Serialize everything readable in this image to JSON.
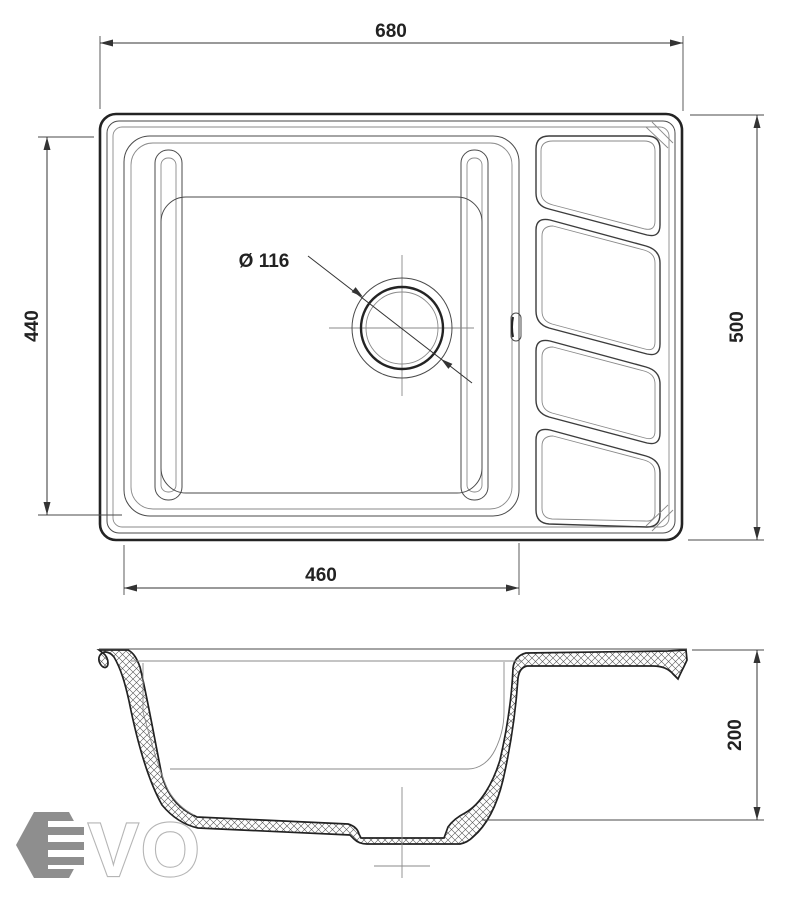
{
  "drawing": {
    "dimensions": {
      "overall_width": "680",
      "overall_depth": "500",
      "bowl_depth": "440",
      "bowl_width": "460",
      "bowl_height": "200",
      "drain_diameter": "Ø 116"
    },
    "style": {
      "line_color": "#2b2b2b",
      "dim_color": "#333333",
      "background": "#ffffff"
    }
  },
  "logo": {
    "vo": "VO",
    "hex_color": "#8e8e8e",
    "outline_color": "#b5b5b5"
  }
}
